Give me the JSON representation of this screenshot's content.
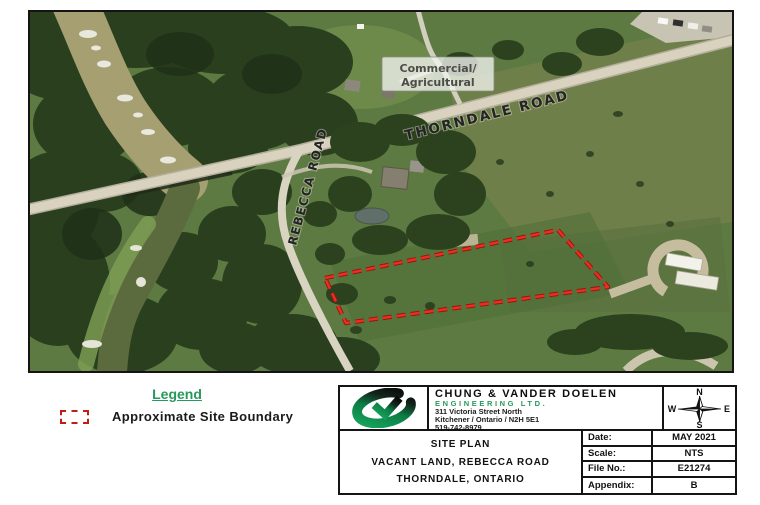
{
  "map": {
    "road_label_thorndale": "THORNDALE ROAD",
    "road_label_rebecca": "REBECCA ROAD",
    "zoning_line1": "Commercial/",
    "zoning_line2": "Agricultural",
    "boundary_color": "#ef2d1f"
  },
  "legend": {
    "title": "Legend",
    "item_label": "Approximate Site Boundary",
    "swatch_color": "#c01d17",
    "title_color": "#27995c"
  },
  "title_block": {
    "company_name": "CHUNG & VANDER DOELEN",
    "company_subtitle": "ENGINEERING LTD.",
    "address_line1": "311 Victoria Street North",
    "address_line2": "Kitchener / Ontario / N2H 5E1",
    "phone": "519-742-8979",
    "accent_green": "#27995c",
    "project_line1": "SITE PLAN",
    "project_line2": "VACANT LAND, REBECCA ROAD",
    "project_line3": "THORNDALE, ONTARIO",
    "compass": {
      "north": "N",
      "east": "E",
      "south": "S",
      "west": "W"
    },
    "meta": [
      {
        "label": "Date:",
        "value": "MAY 2021"
      },
      {
        "label": "Scale:",
        "value": "NTS"
      },
      {
        "label": "File No.:",
        "value": "E21274"
      },
      {
        "label": "Appendix:",
        "value": "B"
      }
    ]
  }
}
